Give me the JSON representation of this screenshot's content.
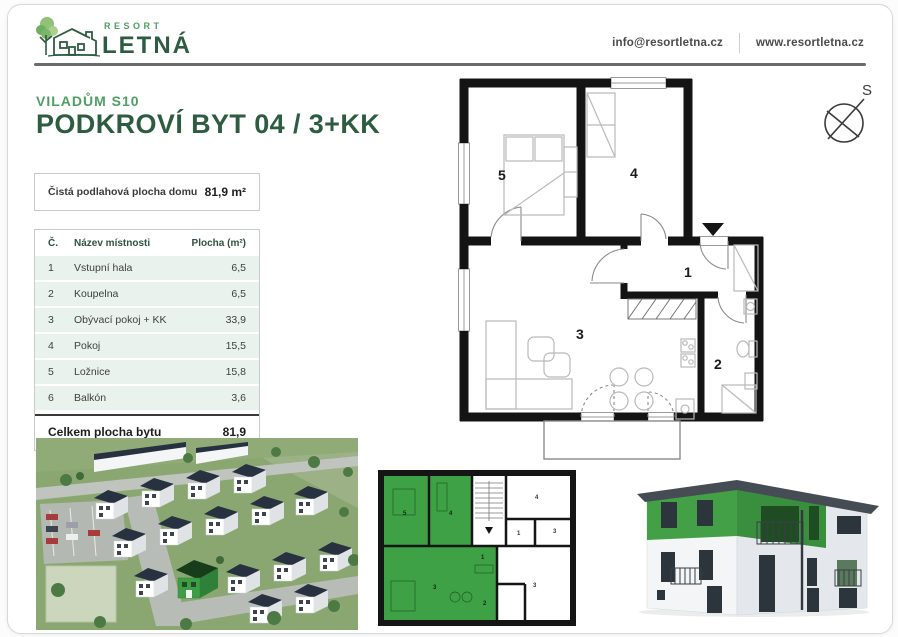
{
  "header": {
    "brand_top": "RESORT",
    "brand_name": "LETNÁ",
    "email": "info@resortletna.cz",
    "website": "www.resortletna.cz"
  },
  "listing": {
    "building": "VILADŮM S10",
    "title": "PODKROVÍ BYT 04 / 3+KK"
  },
  "summary": {
    "label": "Čistá podlahová plocha domu",
    "value": "81,9 m²"
  },
  "room_table": {
    "col_number": "Č.",
    "col_name": "Název místnosti",
    "col_area": "Plocha (m²)",
    "rows": [
      {
        "n": "1",
        "name": "Vstupní hala",
        "area": "6,5"
      },
      {
        "n": "2",
        "name": "Koupelna",
        "area": "6,5"
      },
      {
        "n": "3",
        "name": "Obývací pokoj + KK",
        "area": "33,9"
      },
      {
        "n": "4",
        "name": "Pokoj",
        "area": "15,5"
      },
      {
        "n": "5",
        "name": "Ložnice",
        "area": "15,8"
      },
      {
        "n": "6",
        "name": "Balkón",
        "area": "3,6"
      }
    ],
    "total_label": "Celkem plocha bytu",
    "total_value": "81,9"
  },
  "floor_plan": {
    "compass": "S",
    "labels": {
      "hall": "1",
      "bathroom": "2",
      "living": "3",
      "room": "4",
      "bedroom": "5"
    }
  },
  "mini_plan": {
    "green_labels": [
      "5",
      "4",
      "1",
      "3",
      "2"
    ],
    "white_labels": [
      "4",
      "1",
      "3",
      "3"
    ]
  },
  "colors": {
    "brand_green": "#4f9e63",
    "dark_green": "#2e5c41",
    "highlight_green": "#3fa146",
    "row_green": "#e9f2ec"
  }
}
